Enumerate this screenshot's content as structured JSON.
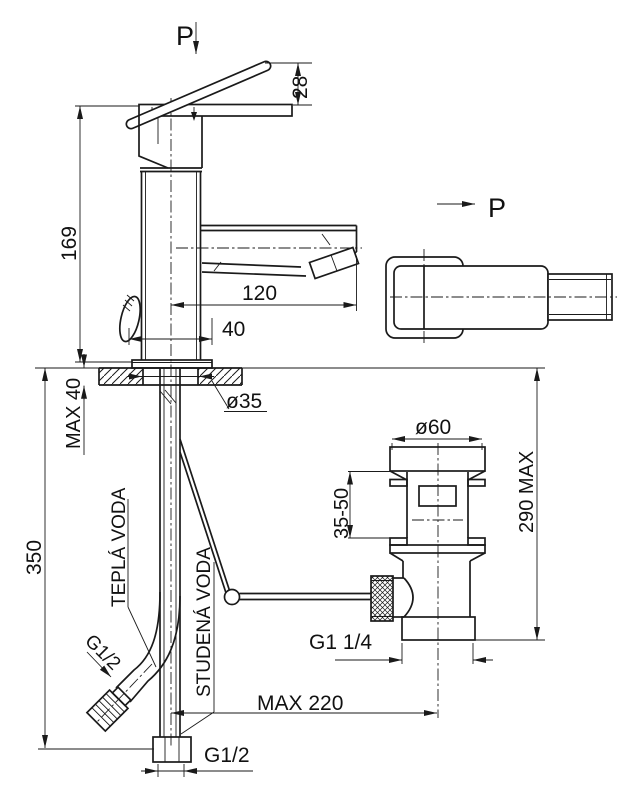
{
  "drawing": {
    "title_hint": "faucet-technical-drawing",
    "colors": {
      "background": "#ffffff",
      "line": "#1a1a1a"
    },
    "views": {
      "section_arrow_top": "P",
      "section_arrow_side": "P"
    },
    "labels": {
      "lever_height": "28",
      "spout_height": "169",
      "spout_reach": "120",
      "base_width": "40",
      "deck_thickness": "MAX 40",
      "mount_hole": "ø35",
      "supply_length": "350",
      "hot_supply": "TEPLÁ VODA",
      "cold_supply": "STUDENÁ VODA",
      "supply_thread": "G1/2",
      "shank_thread": "G1/2",
      "waste_flange": "ø60",
      "clamp_range": "35-50",
      "waste_height": "290 MAX",
      "waste_thread": "G1 1/4",
      "pop_up_reach": "MAX 220"
    }
  }
}
